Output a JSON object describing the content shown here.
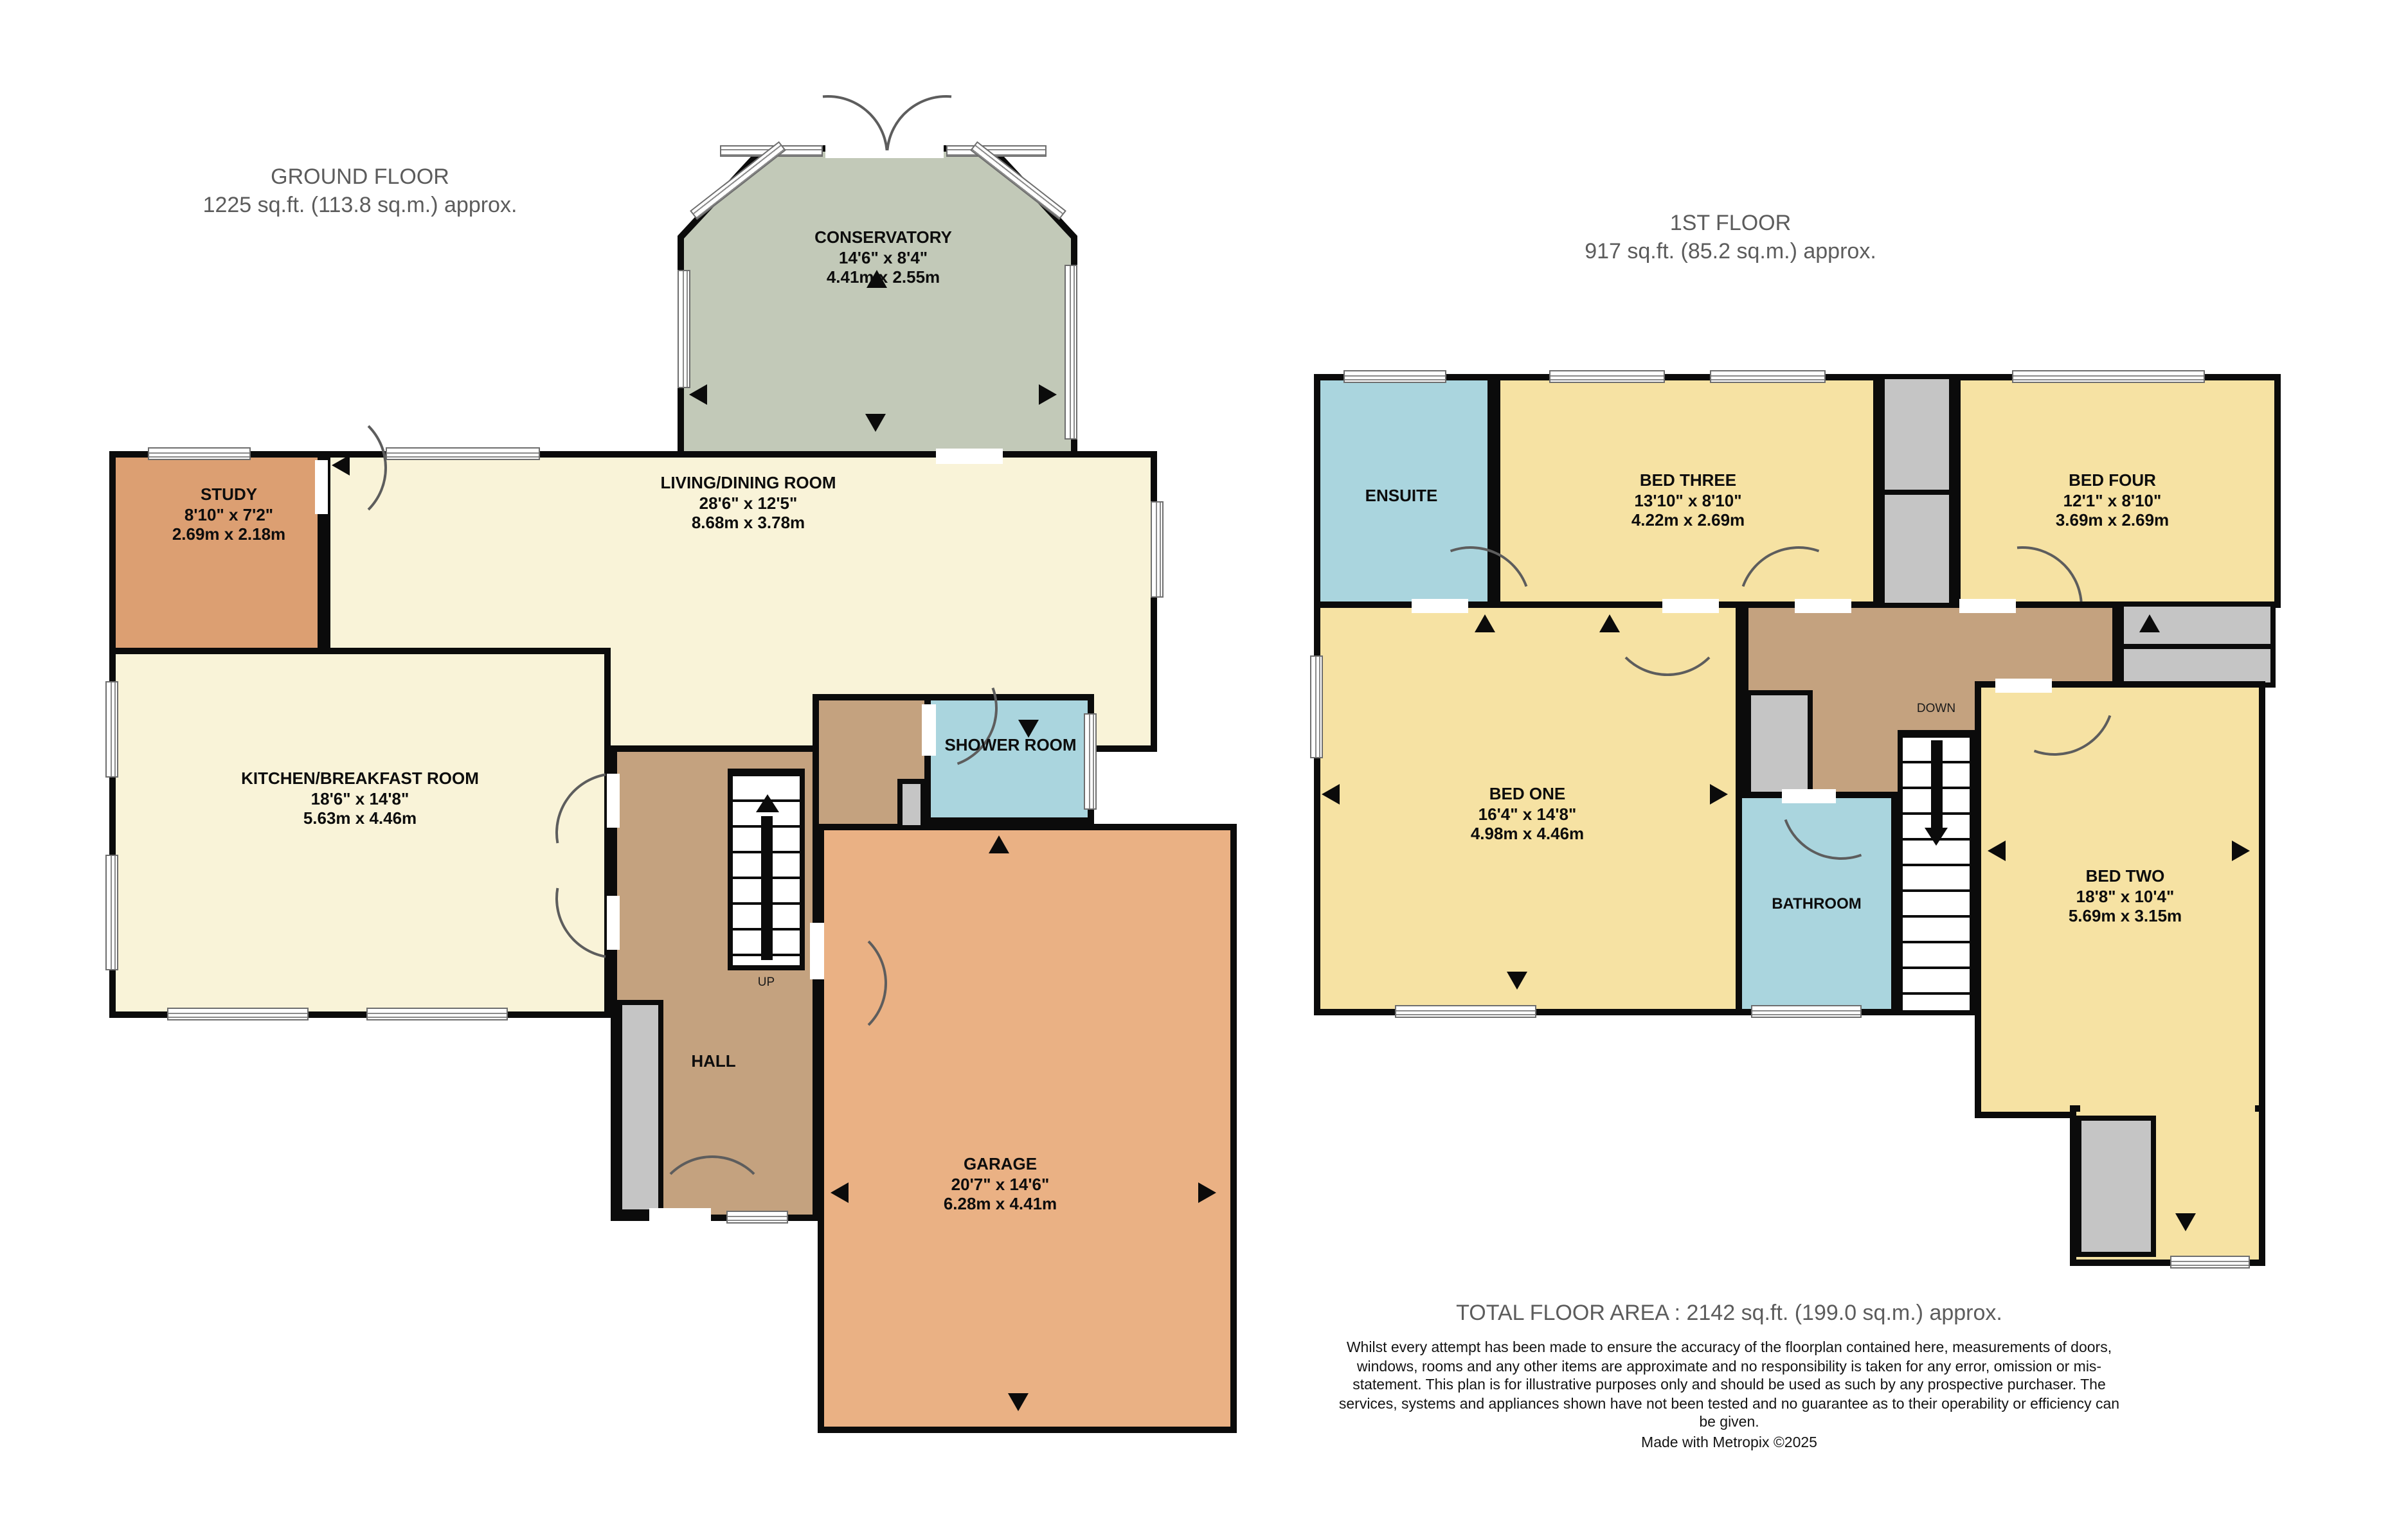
{
  "ground": {
    "title": "GROUND FLOOR",
    "subtitle": "1225 sq.ft. (113.8 sq.m.) approx.",
    "stairs_label": "UP",
    "rooms": {
      "conservatory": {
        "name": "CONSERVATORY",
        "imperial": "14'6\"  x 8'4\"",
        "metric": "4.41m  x 2.55m"
      },
      "study": {
        "name": "STUDY",
        "imperial": "8'10\"  x 7'2\"",
        "metric": "2.69m  x 2.18m"
      },
      "living": {
        "name": "LIVING/DINING ROOM",
        "imperial": "28'6\"  x 12'5\"",
        "metric": "8.68m  x 3.78m"
      },
      "kitchen": {
        "name": "KITCHEN/BREAKFAST ROOM",
        "imperial": "18'6\"  x 14'8\"",
        "metric": "5.63m  x 4.46m"
      },
      "shower": {
        "name": "SHOWER ROOM"
      },
      "hall": {
        "name": "HALL"
      },
      "garage": {
        "name": "GARAGE",
        "imperial": "20'7\"  x 14'6\"",
        "metric": "6.28m  x 4.41m"
      }
    }
  },
  "first": {
    "title": "1ST FLOOR",
    "subtitle": "917 sq.ft. (85.2 sq.m.) approx.",
    "stairs_label": "DOWN",
    "rooms": {
      "ensuite": {
        "name": "ENSUITE"
      },
      "bed_three": {
        "name": "BED THREE",
        "imperial": "13'10\"  x 8'10\"",
        "metric": "4.22m  x 2.69m"
      },
      "bed_four": {
        "name": "BED FOUR",
        "imperial": "12'1\"  x 8'10\"",
        "metric": "3.69m  x 2.69m"
      },
      "bed_one": {
        "name": "BED ONE",
        "imperial": "16'4\"  x 14'8\"",
        "metric": "4.98m  x 4.46m"
      },
      "bathroom": {
        "name": "BATHROOM"
      },
      "bed_two": {
        "name": "BED TWO",
        "imperial": "18'8\"  x 10'4\"",
        "metric": "5.69m  x 3.15m"
      }
    }
  },
  "footer": {
    "total": "TOTAL FLOOR AREA : 2142 sq.ft. (199.0 sq.m.) approx.",
    "disclaimer": "Whilst every attempt has been made to ensure the accuracy of the floorplan contained here, measurements of doors, windows, rooms and any other items are approximate and no responsibility is taken for any error, omission or mis-statement. This plan is for illustrative purposes only and should be used as such by any prospective purchaser. The services, systems and appliances shown have not been tested and no guarantee as to their operability or efficiency can be given.",
    "credit": "Made with Metropix ©2025"
  },
  "colors": {
    "wall": "#0b0b0b",
    "cream": "#f9f3d8",
    "study_orange": "#dc9f72",
    "garage_orange": "#eab184",
    "conservatory_sage": "#c2c9b8",
    "wet_room_blue": "#aad5de",
    "hall_brown": "#c4a27f",
    "bedroom_yellow": "#f6e2a3",
    "cupboard_grey": "#c5c5c5",
    "title_grey": "#5c5c5c"
  }
}
